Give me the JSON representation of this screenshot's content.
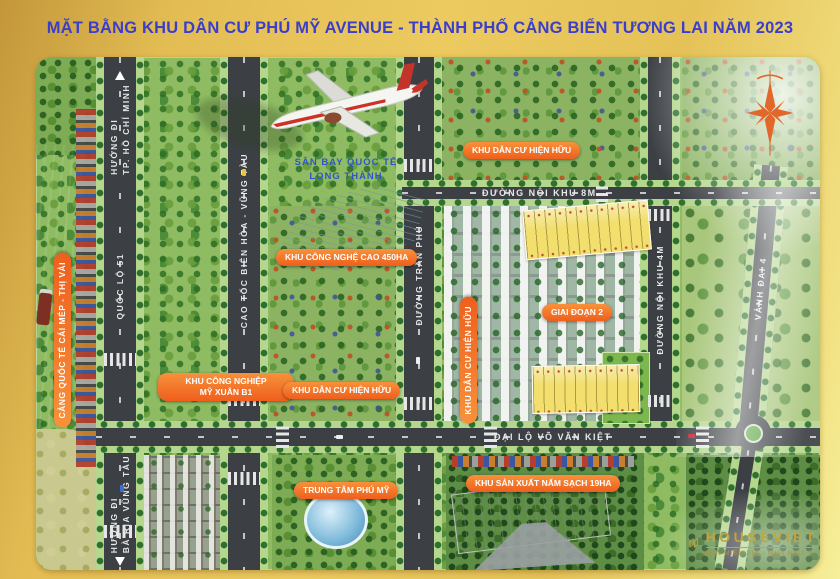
{
  "title": "MẶT BẰNG KHU DÂN CƯ PHÚ MỸ AVENUE - THÀNH PHỐ CẢNG BIỂN TƯƠNG LAI NĂM 2023",
  "map": {
    "roads": {
      "quoc_lo_51": {
        "label": "QUỐC LỘ 51"
      },
      "huong_hcm": {
        "line1": "HƯỚNG ĐI",
        "line2": "TP. HỒ CHÍ MINH"
      },
      "huong_brvt": {
        "line1": "HƯỚNG ĐI",
        "line2": "BÀ RỊA VŨNG TÀU"
      },
      "cao_toc": {
        "label": "CAO TỐC BIÊN HÒA - VŨNG TÀU"
      },
      "tran_phu": {
        "label": "ĐƯỜNG TRẦN PHÚ"
      },
      "noi_khu_8m": {
        "label": "ĐƯỜNG NỘI KHU 8M"
      },
      "noi_khu_4m": {
        "label": "ĐƯỜNG NỘI KHU 4M"
      },
      "vanh_dai_4": {
        "label": "VÀNH ĐAI 4"
      },
      "vo_van_kiet": {
        "label": "ĐẠI LỘ VÕ VĂN KIỆT"
      }
    },
    "labels": {
      "cang": "CẢNG QUỐC TẾ CÁI MÉP - THỊ VẢI",
      "san_bay_l1": "SÂN BAY QUỐC TẾ",
      "san_bay_l2": "LONG THÀNH",
      "cong_nghe_cao": "KHU CÔNG NGHỆ CAO 450HA",
      "kcn_l1": "KHU CÔNG NGHIỆP",
      "kcn_l2": "MỸ XUÂN B1",
      "kdc_top": "KHU DÂN CƯ HIỆN HỮU",
      "kdc_mid": "KHU DÂN CƯ HIỆN HỮU",
      "kdc_project": "KHU DÂN CƯ HIỆN HỮU",
      "giai_doan_2": "GIAI ĐOẠN 2",
      "trung_tam": "TRUNG TÂM PHÚ MỸ",
      "nam_sach": "KHU SẢN XUẤT NẤM SẠCH 19HA"
    }
  },
  "branding": {
    "logo": "HOUSEVIET",
    "tagline": "BÁN MIỄN PHÍ - MUA NHƯ Ý"
  },
  "colors": {
    "frame_gold": "#e5c258",
    "title_blue": "#3b3ecb",
    "accent_orange": "#ee5f1d",
    "road_gray": "#3c4044",
    "water_teal": "#2d9c96",
    "lot_yellow": "#f2df6e",
    "logo_gold": "#c8a23a"
  }
}
